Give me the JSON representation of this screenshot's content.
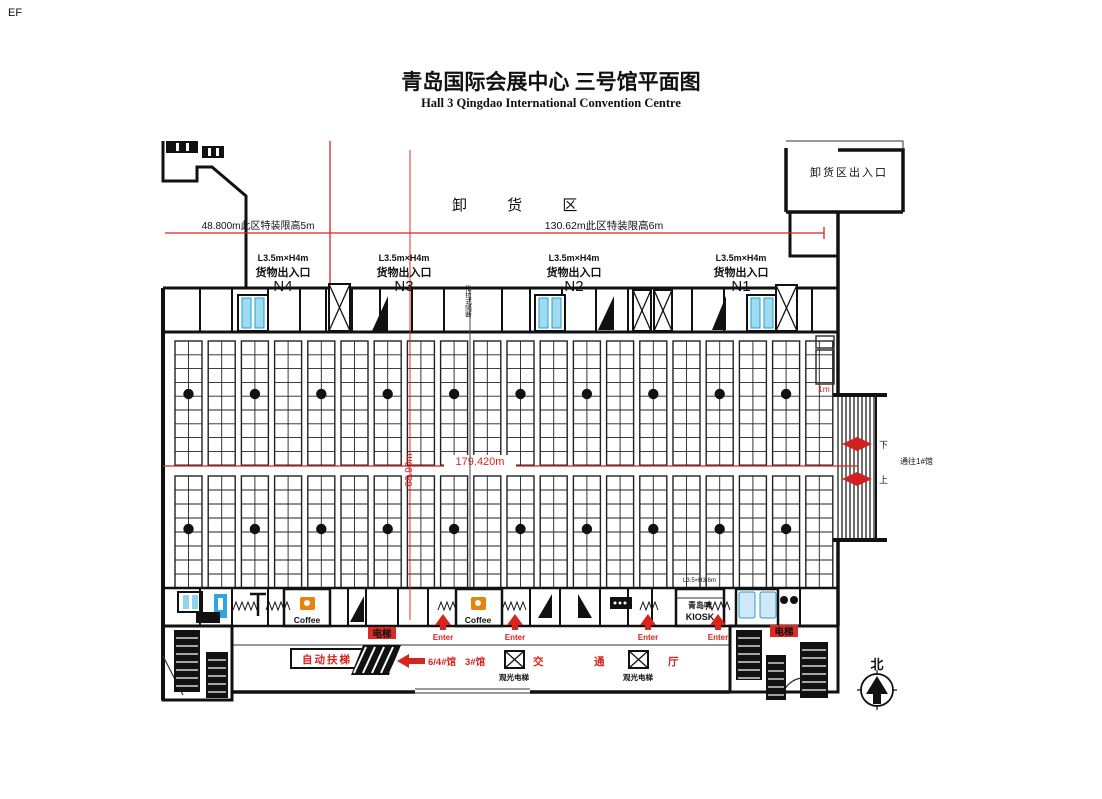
{
  "page": {
    "corner_label": "EF"
  },
  "header": {
    "title": "青岛国际会展中心 三号馆平面图",
    "subtitle": "Hall 3 Qingdao International Convention Centre"
  },
  "unloading_area": {
    "label": "卸  货  区",
    "entrance": "卸货区出入口",
    "zone_left": "48.800m此区特装限高5m",
    "zone_right": "130.62m此区特装限高6m"
  },
  "gates": [
    {
      "size": "L3.5m×H4m",
      "type": "货物出入口",
      "id": "N4"
    },
    {
      "size": "L3.5m×H4m",
      "type": "货物出入口",
      "id": "N3"
    },
    {
      "size": "L3.5m×H4m",
      "type": "货物出入口",
      "id": "N2"
    },
    {
      "size": "L3.5m×H4m",
      "type": "货物出入口",
      "id": "N1"
    }
  ],
  "partition_label": "推拉式隔断",
  "dimensions": {
    "hall_width": "179.420m",
    "hall_depth": "68.90m",
    "right_note": "1m",
    "booth_note": "L3.5×H3.6m"
  },
  "connector": {
    "label": "通往1#馆",
    "down": "下",
    "up": "上"
  },
  "services": {
    "coffee": "Coffee",
    "elevator": "电梯",
    "enter": "Enter",
    "kiosk_top": "青岛啤",
    "kiosk": "KIOSK"
  },
  "lobby": {
    "escalator": "自动扶梯",
    "to_halls": "6/4#馆",
    "hall": "3#馆",
    "hall_char_1": "交",
    "hall_char_2": "通",
    "hall_char_3": "厅",
    "sightseeing_elevator": "观光电梯",
    "north": "北"
  },
  "colors": {
    "wall": "#111111",
    "accent_red": "#d8241f",
    "door_blue": "#8fd4ef",
    "coffee_orange": "#e8820c"
  },
  "booths": {
    "x_start": 175,
    "block_width": 27,
    "block_gap": 6.2,
    "block_count": 20,
    "cells_per_block": 2,
    "pillar_block_step": 2,
    "bands": [
      {
        "y": 341,
        "rows": 9,
        "row_height": 13.8,
        "pillar_y": 394
      },
      {
        "y": 476,
        "rows": 8,
        "row_height": 14.0,
        "pillar_y": 529
      }
    ]
  }
}
